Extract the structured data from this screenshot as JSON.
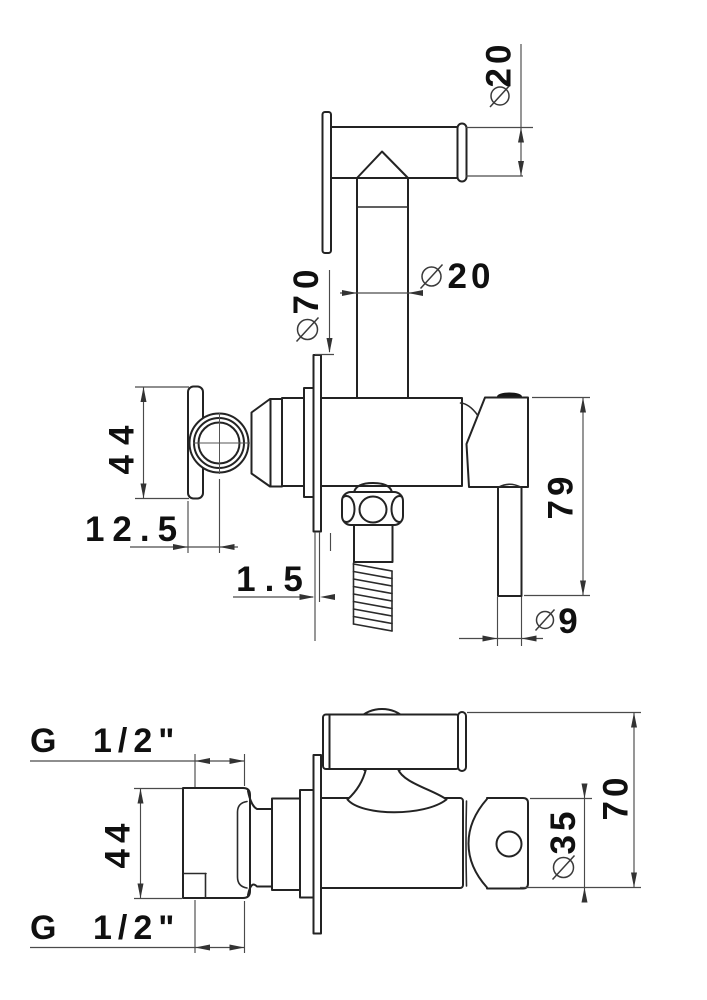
{
  "drawing": {
    "title": "Wall-mounted bidet hand spray with stop valve - dimensioned technical drawing",
    "background_color": "#ffffff",
    "line_color": "#232323",
    "front_view": {
      "dims": {
        "nozzle_diameter": {
          "symbol": "⌀",
          "value": "20"
        },
        "pipe_diameter": {
          "symbol": "⌀",
          "value": "20"
        },
        "flange_diameter": {
          "symbol": "⌀",
          "value": "70"
        },
        "bracket_height": {
          "value": "44"
        },
        "bracket_offset": {
          "value": "12.5"
        },
        "flange_thickness": {
          "value": "1.5"
        },
        "handle_length": {
          "value": "79"
        },
        "handle_diameter": {
          "symbol": "⌀",
          "value": "9"
        }
      }
    },
    "top_view": {
      "dims": {
        "inlet_thread_top": {
          "prefix": "G",
          "value": "1/2\""
        },
        "inlet_thread_bottom": {
          "prefix": "G",
          "value": "1/2\""
        },
        "inlet_height": {
          "value": "44"
        },
        "body_diameter": {
          "symbol": "⌀",
          "value": "35"
        },
        "overall_depth": {
          "value": "70"
        }
      }
    }
  }
}
